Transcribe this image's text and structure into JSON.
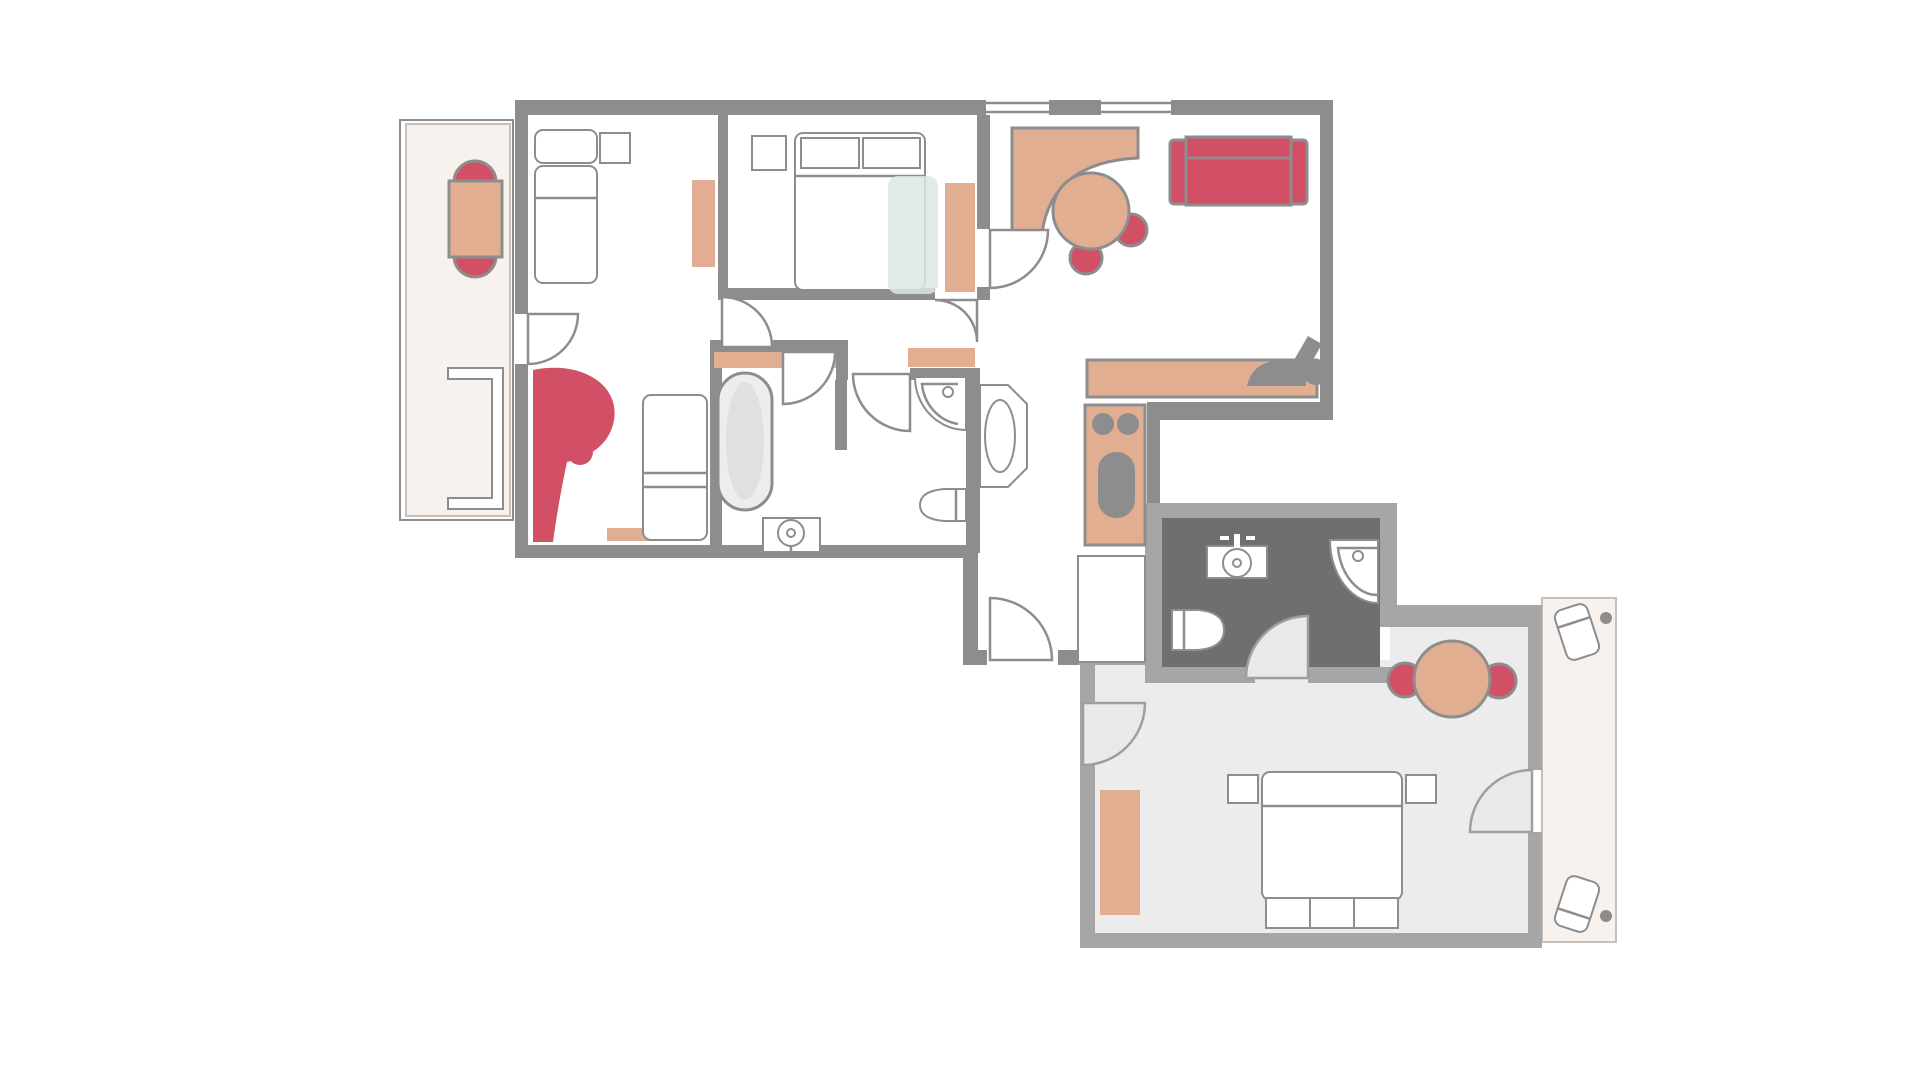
{
  "type": "floor-plan",
  "title": "Two-unit apartment floor plan",
  "colors": {
    "wall-upper": "#8d8d8d",
    "wall-lower": "#a6a6a6",
    "line": "#8d8d8d",
    "accent-tan": "#e2ae92",
    "accent-red": "#d25066",
    "accent-blue": "#dae7e3",
    "floor-lower": "#ececec",
    "floor-bath": "#6f6f6f",
    "floor-balcony": "#f8f2ef",
    "balcony-line": "#c9beb8",
    "fixture-white": "#ffffff"
  },
  "icons": {
    "dining-table-icon": "accent-tan",
    "chair-icon": "accent-red",
    "sofa-icon": "accent-red",
    "round-table-icon": "accent-tan",
    "desk-icon": "accent-tan",
    "rug-icon": "accent-tan",
    "kitchen-unit-icon": "accent-tan",
    "bed-icon": "fixture-white",
    "bathtub-icon": "fixture-white",
    "shower-icon": "fixture-white",
    "toilet-icon": "fixture-white",
    "washbasin-icon": "fixture-white",
    "lounger-icon": "fixture-white",
    "throw-blanket-icon": "accent-blue",
    "accent-chair-icon": "accent-red",
    "chaise-icon": "line"
  },
  "rooms": [
    "balcony-upper",
    "bedroom-1",
    "bedroom-2",
    "living-room",
    "kitchen-corridor",
    "bathroom-main",
    "hallway",
    "entry-vestibule",
    "bathroom-lower",
    "studio-room-lower",
    "terrace-lower"
  ]
}
